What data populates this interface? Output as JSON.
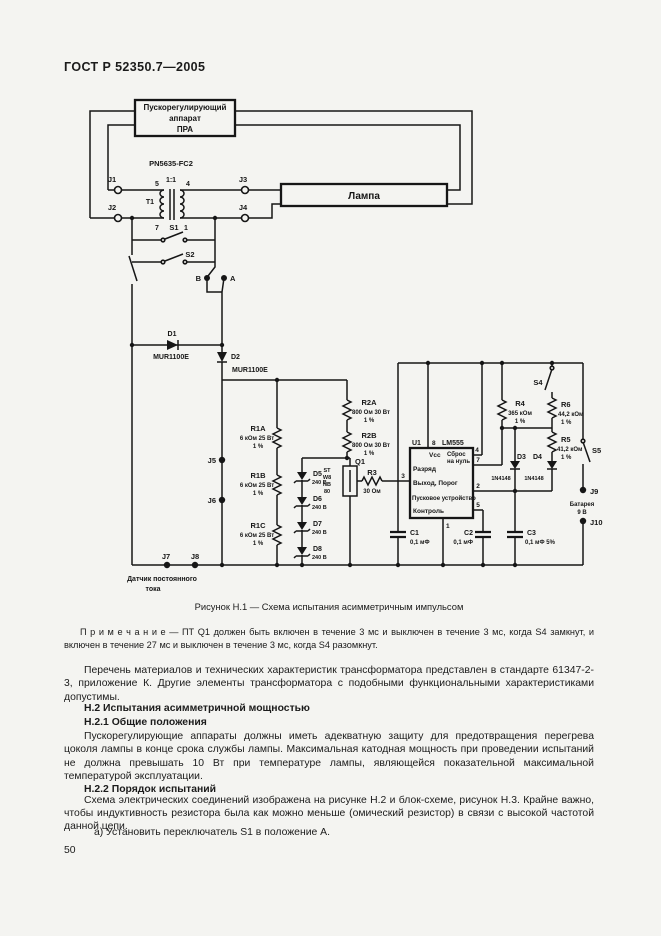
{
  "document": {
    "header": "ГОСТ Р 52350.7—2005",
    "caption": "Рисунок Н.1 — Схема испытания асимметричным импульсом",
    "note": "П р и м е ч а н и е — ПТ Q1 должен быть включен в течение 3 мс и выключен в течение 3 мс, когда S4 замкнут, и включен в течение 27 мс и выключен в течение 3 мс, когда S4 разомкнут.",
    "para1": "Перечень материалов и технических характеристик трансформатора представлен в стандарте 61347-2-3, приложение К. Другие элементы трансформатора с подобными функциональными характеристиками допустимы.",
    "h2": "Н.2 Испытания асимметричной мощностью",
    "h21": "Н.2.1 Общие положения",
    "para2": "Пускорегулирующие аппараты должны иметь адекватную защиту для предотвращения перегрева цоколя лампы в конце срока службы лампы. Максимальная катодная мощность при проведении испытаний не должна превышать 10 Вт при температуре лампы, являющейся показательной максимальной температурой эксплуатации.",
    "h22": "Н.2.2 Порядок испытаний",
    "para3": "Схема электрических соединений изображена на рисунке Н.2 и блок-схеме, рисунок Н.3. Крайне важно, чтобы индуктивность резистора была как можно меньше (омический резистор) в связи с высокой частотой данной цепи.",
    "item_a": "а) Установить переключатель S1 в положение А.",
    "page_number": "50"
  },
  "schematic": {
    "ballast_l1": "Пускорегулирующий",
    "ballast_l2": "аппарат",
    "ballast_l3": "ПРА",
    "lamp": "Лампа",
    "xfmr_part": "PN5635-FC2",
    "xfmr_ratio": "1:1",
    "xfmr_ref": "T1",
    "xfmr_pin5": "5",
    "xfmr_pin4": "4",
    "xfmr_pin7": "7",
    "xfmr_pin1": "1",
    "j1": "J1",
    "j2": "J2",
    "j3": "J3",
    "j4": "J4",
    "j5": "J5",
    "j6": "J6",
    "j7": "J7",
    "j8": "J8",
    "j9": "J9",
    "j10": "J10",
    "s1": "S1",
    "s2": "S2",
    "s4": "S4",
    "s5": "S5",
    "pos_b": "B",
    "pos_a": "A",
    "d1_ref": "D1",
    "d1_part": "MUR1100E",
    "d2_ref": "D2",
    "d2_part": "MUR1100E",
    "d3_ref": "D3",
    "d3_part": "1N4148",
    "d4_ref": "D4",
    "d4_part": "1N4148",
    "d5_ref": "D5",
    "d5_val": "240 В",
    "d6_ref": "D6",
    "d6_val": "240 В",
    "d7_ref": "D7",
    "d7_val": "240 В",
    "d8_ref": "D8",
    "d8_val": "240 В",
    "r1a_ref": "R1A",
    "r1a_val": "6 кОм 25 Вт",
    "r1a_tol": "1 %",
    "r1b_ref": "R1B",
    "r1b_val": "6 кОм 25 Вт",
    "r1b_tol": "1 %",
    "r1c_ref": "R1C",
    "r1c_val": "6 кОм 25 Вт",
    "r1c_tol": "1 %",
    "r2a_ref": "R2A",
    "r2a_val": "800 Ом 30 Вт",
    "r2a_tol": "1 %",
    "r2b_ref": "R2B",
    "r2b_val": "800 Ом 30 Вт",
    "r2b_tol": "1 %",
    "r3_ref": "R3",
    "r3_val": "30 Ом",
    "r4_ref": "R4",
    "r4_val": "365 кОм",
    "r4_tol": "1 %",
    "r5_ref": "R5",
    "r5_val": "41,2 кОм",
    "r5_tol": "1 %",
    "r6_ref": "R6",
    "r6_val": "44,2 кОм",
    "r6_tol": "1 %",
    "q1_ref": "Q1",
    "q1_part_l1": "ST",
    "q1_part_l2": "W8",
    "q1_part_l3": "NB",
    "q1_part_l4": "80",
    "u1_ref": "U1",
    "u1_pin8": "8",
    "u1_part": "LM555",
    "u1_vcc": "Vcc",
    "u1_reset_l1": "Сброс",
    "u1_reset_l2": "на нуль",
    "u1_discharge": "Разряд",
    "u1_output": "Выход, Порог",
    "u1_trigger": "Пусковое устройство",
    "u1_control": "Контроль",
    "u1_pin3": "3",
    "u1_pin4": "4",
    "u1_pin7": "7",
    "u1_pin2": "2",
    "u1_pin5": "5",
    "u1_pin1": "1",
    "c1_ref": "C1",
    "c1_val": "0,1 мФ",
    "c2_ref": "C2",
    "c2_val": "0,1 мФ",
    "c3_ref": "C3",
    "c3_val": "0,1 мФ 5%",
    "battery_l1": "Батарея",
    "battery_l2": "9 В",
    "sensor_l1": "Датчик постоянного",
    "sensor_l2": "тока"
  },
  "colors": {
    "ink": "#161616",
    "paper": "#f4f4f1"
  }
}
